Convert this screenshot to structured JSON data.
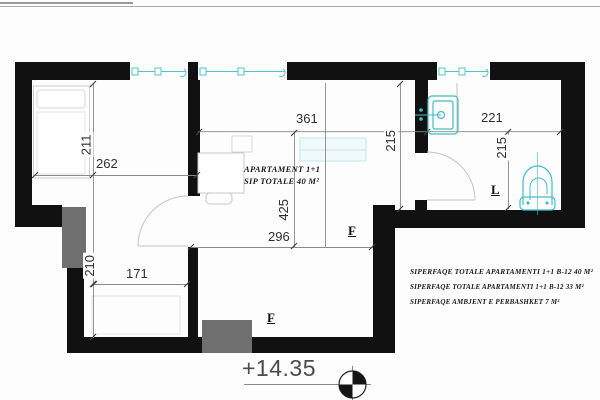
{
  "drawing": {
    "apartment_label": {
      "line1": "APARTAMENT  1+1",
      "line2": "SIP TOTALE  40 M²"
    },
    "dimensions": {
      "bedroom_height": "211",
      "bedroom_width": "262",
      "living_width": "361",
      "bath_height": "215",
      "bath_width": "221",
      "wc_height": "215",
      "living_height": "425",
      "living_lower_width": "296",
      "room2_width": "171",
      "room2_height": "210"
    },
    "tags": {
      "living_f": "F",
      "lower_f": "F",
      "wc_l": "L"
    },
    "level_marker": {
      "value": "+14.35"
    },
    "summary": {
      "line1": "SIPERFAQE TOTALE APARTAMENTI 1+1 B-12  40 M²",
      "line2": "SIPERFAQE TOTALE APARTAMENTI 1+1 B-12  33 M²",
      "line3": "SIPERFAQE AMBJENT E PERBASHKET   7 M²"
    },
    "colors": {
      "wall": "#111111",
      "column": "#6f6f6f",
      "fixture": "#3fbfc5",
      "dim_text": "#2e2e2e"
    }
  }
}
